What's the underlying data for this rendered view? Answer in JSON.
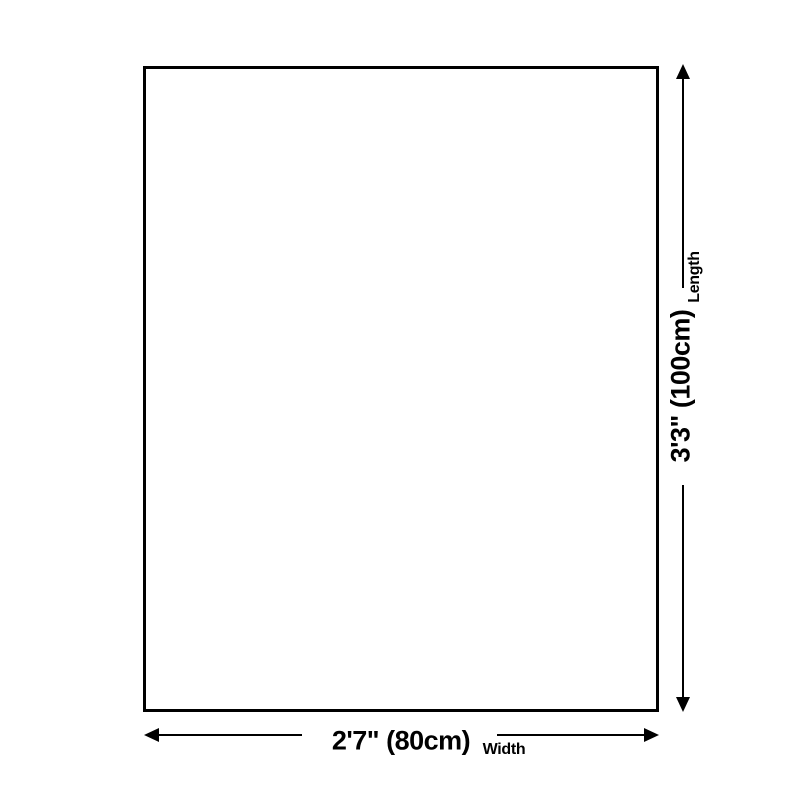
{
  "diagram": {
    "type": "product-dimension-diagram",
    "shape": "rectangle",
    "length": {
      "value": "3'3\" (100cm)",
      "caption": "Length"
    },
    "width": {
      "value": "2'7\" (80cm)",
      "caption": "Width"
    },
    "colors": {
      "line": "#000000",
      "background": "#ffffff"
    },
    "icons": [
      "arrow-up-icon",
      "arrow-down-icon",
      "arrow-left-icon",
      "arrow-right-icon"
    ]
  }
}
